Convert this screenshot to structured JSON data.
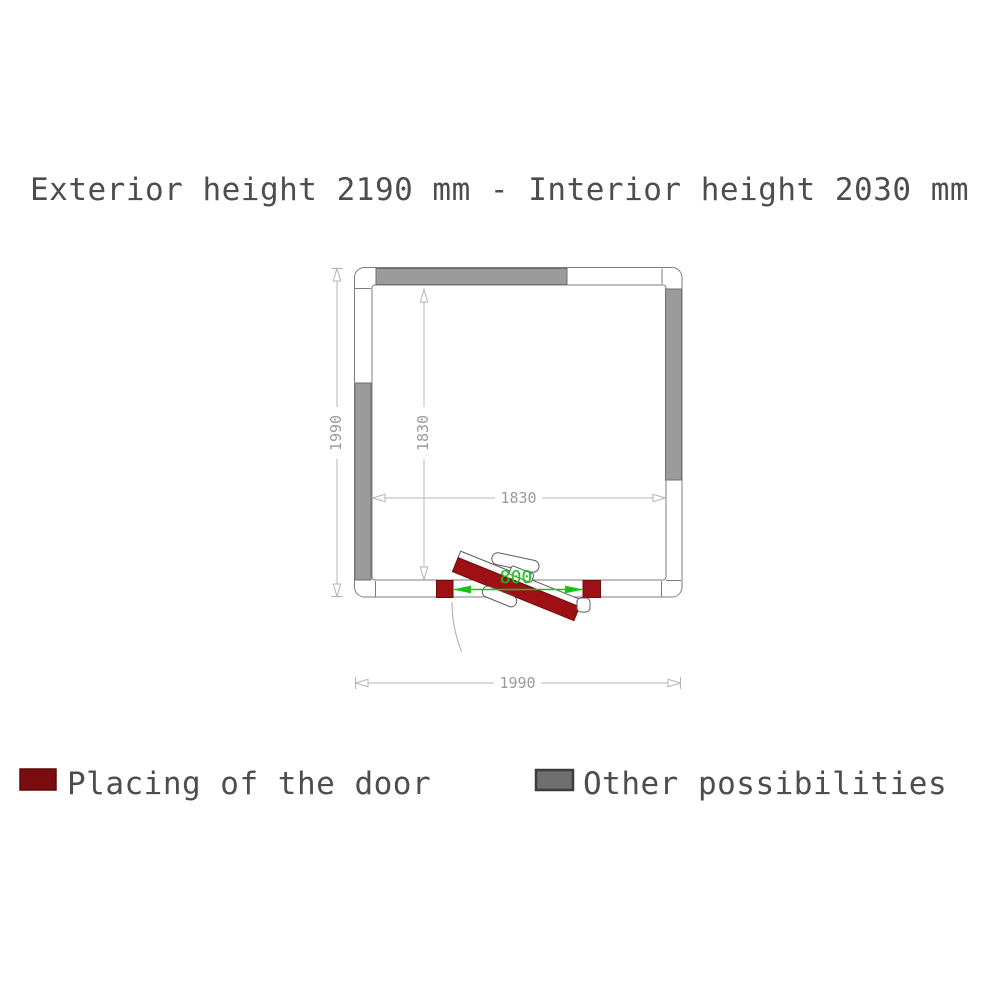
{
  "title": "Exterior height 2190 mm - Interior height 2030 mm",
  "plan": {
    "type": "floor-plan",
    "description": "Square cold room plan with outward-opening door at bottom",
    "dimensions": {
      "exterior_depth_mm": "1990",
      "exterior_width_mm": "1990",
      "interior_depth_mm": "1830",
      "interior_width_mm": "1830",
      "door_width_mm": "800"
    }
  },
  "legend": {
    "door_label": "Placing of the door",
    "other_label": "Other possibilities"
  },
  "colors": {
    "door_red": "#9e1013",
    "door_swatch_red": "#7b0d11",
    "wall_gray": "#9b9b9b",
    "other_swatch_gray": "#6f6f6f",
    "dim_green": "#16c416",
    "dim_gray": "#b4b4b4",
    "text_gray": "#4d4d4d"
  }
}
